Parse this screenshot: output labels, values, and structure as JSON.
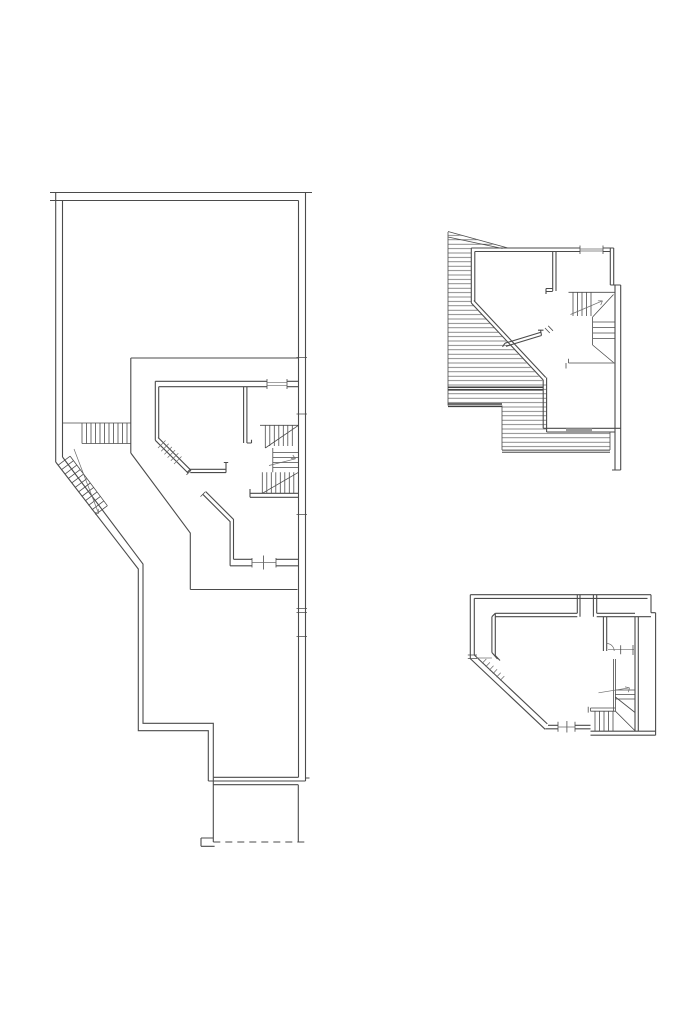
{
  "canvas": {
    "width": 683,
    "height": 1023,
    "background": "#ffffff"
  },
  "drawing": {
    "kind": "architectural floor plan line drawing",
    "visible_text": [],
    "line_color": "#4b4b4b",
    "thin_line_color": "#6a6a6a",
    "hatch_line_color": "#5a5a5a",
    "thick_line_color": "#3f3f3f",
    "threshold_fill_color": "#9a9a9a",
    "hatch_style": "closely spaced horizontal lines (roof/low-height zones)",
    "dashed_edge": "dashed boundary at bottom of left plan"
  },
  "plans": [
    {
      "name": "large-floor-plan",
      "position": "left",
      "features": "walled yard, two straight stairs, diagonal corridor, winder staircase, dashed lower edge"
    },
    {
      "name": "attic-floor-plan",
      "position": "top-right",
      "features": "hatched roof slopes, winder staircase, window in top wall"
    },
    {
      "name": "small-floor-plan",
      "position": "bottom-right",
      "features": "diagonal window wall, door with swing arc, winder staircase"
    }
  ]
}
